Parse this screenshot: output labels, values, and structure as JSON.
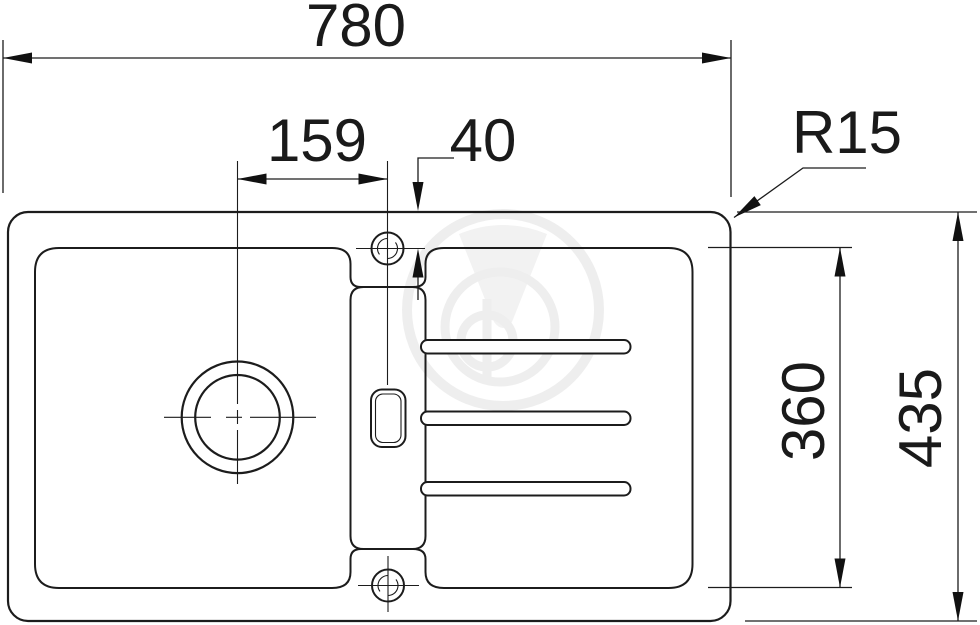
{
  "drawing": {
    "labels": {
      "overall_width": "780",
      "drain_to_tap": "159",
      "tap_to_edge": "40",
      "corner_radius": "R15",
      "rim_depth": "360",
      "overall_depth": "435"
    }
  }
}
